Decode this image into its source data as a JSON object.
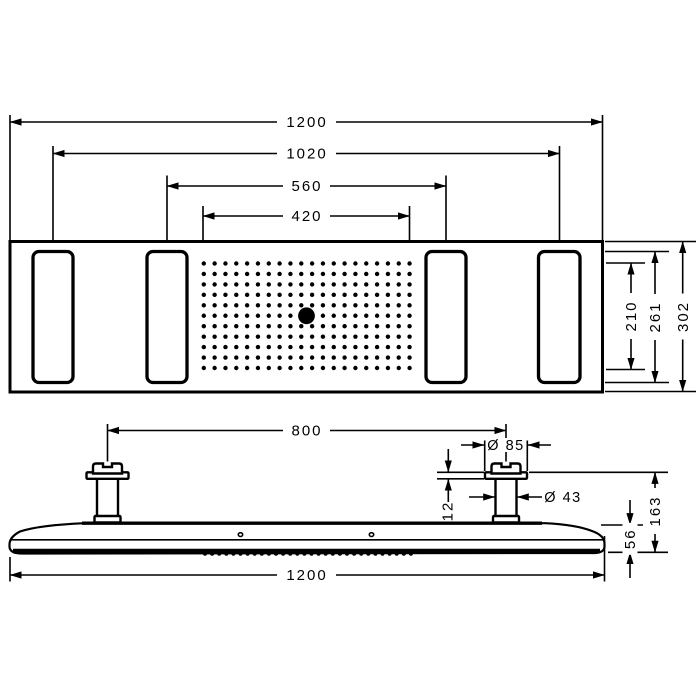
{
  "drawing_type": "product dimension drawing (overhead shower panel, top view and side view)",
  "colors": {
    "ink": "#000000",
    "paper": "#ffffff"
  },
  "labels": {
    "overall_width_top": "1200",
    "outer_zone_spacing": "1020",
    "inner_zone_spacing": "560",
    "nozzle_field_width": "420",
    "nozzle_field_depth": "210",
    "zone_depth": "261",
    "panel_depth": "302",
    "pipe_spacing": "800",
    "flange_diameter": "Ø 85",
    "pipe_diameter": "Ø 43",
    "flange_height": "12",
    "install_height": "163",
    "panel_thickness": "56",
    "overall_width_bottom": "1200"
  }
}
